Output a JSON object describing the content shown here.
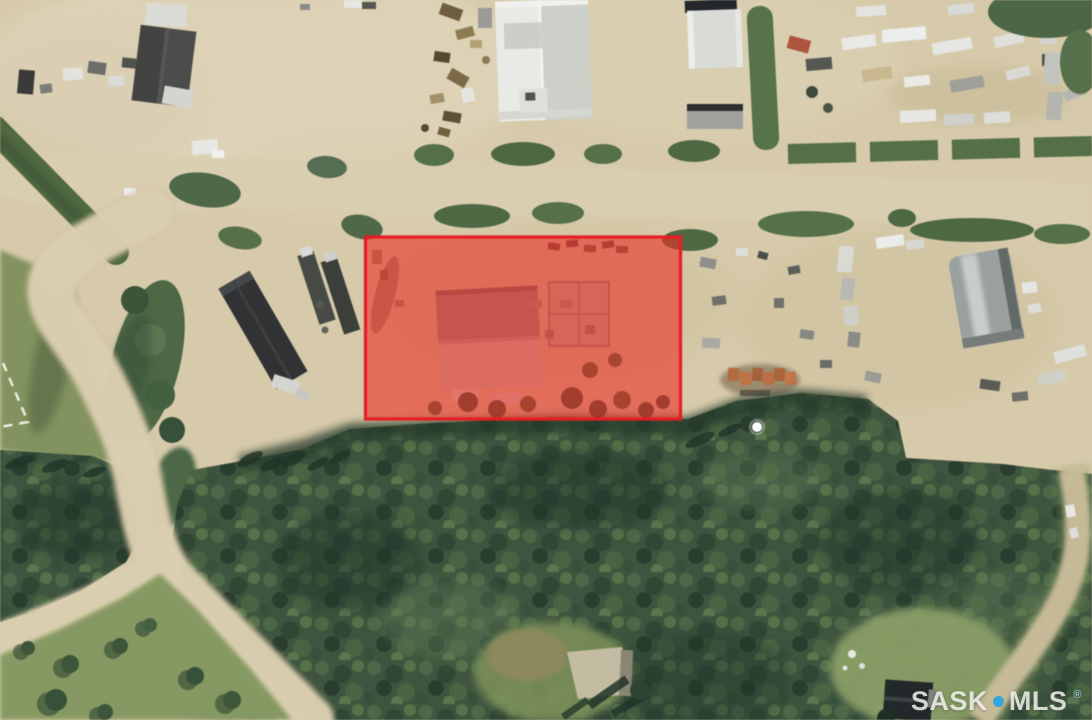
{
  "watermark": {
    "prefix": "SASK",
    "suffix": "MLS",
    "registered": "®",
    "dot_color": "#36A5DB",
    "text_color": "rgba(249,249,245,0.82)"
  },
  "highlight": {
    "label": "highlighted-property-parcel",
    "shape": "rectangle",
    "border_color": "#EB1C23",
    "fill_color": "#EE2E25",
    "fill_opacity": "0.60"
  },
  "marker": {
    "label": "white-location-dot",
    "color": "#FFFFFF"
  },
  "terrain": {
    "sand": "#D6CAA9",
    "road": "#DBCFB0",
    "grass": "#84985F",
    "hedge": "#4E6843",
    "forest": "#3E543E",
    "forest_shadow": "#24372B"
  }
}
